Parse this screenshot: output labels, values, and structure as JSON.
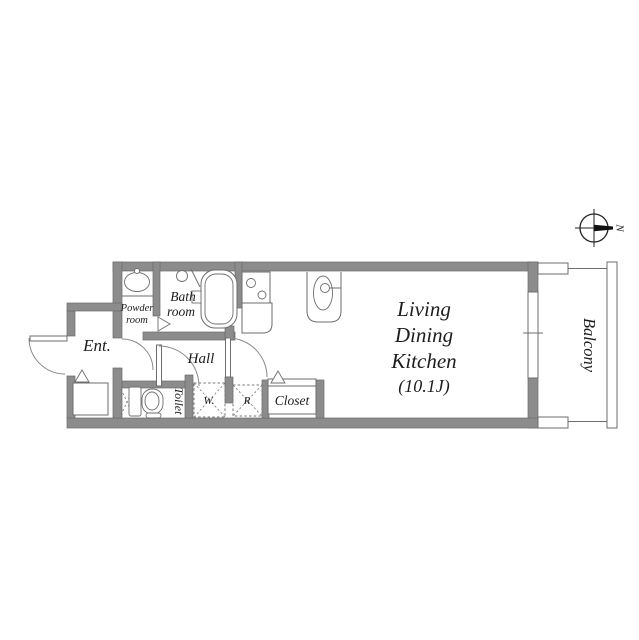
{
  "floor_plan": {
    "title": "apartment-floor-plan",
    "rooms": {
      "powder_room": {
        "label_line1": "Powder",
        "label_line2": "room"
      },
      "bath_room": {
        "label_line1": "Bath",
        "label_line2": "room"
      },
      "entrance": {
        "label": "Ent."
      },
      "hall": {
        "label": "Hall"
      },
      "toilet": {
        "label": "Toilet"
      },
      "washer_space": {
        "label": "W."
      },
      "refrigerator_space": {
        "label": "R"
      },
      "closet": {
        "label": "Closet"
      },
      "ldk": {
        "label_line1": "Living",
        "label_line2": "Dining",
        "label_line3": "Kitchen",
        "label_line4": "(10.1J)",
        "area_tatami": "10.1J"
      },
      "balcony": {
        "label": "Balcony"
      }
    },
    "compass": {
      "label": "N",
      "direction": "right"
    },
    "colors": {
      "wall": "#8c8c8c",
      "wall_edge": "#6b6b6b",
      "line": "#6e6e6e",
      "text": "#1d1d1d"
    }
  }
}
